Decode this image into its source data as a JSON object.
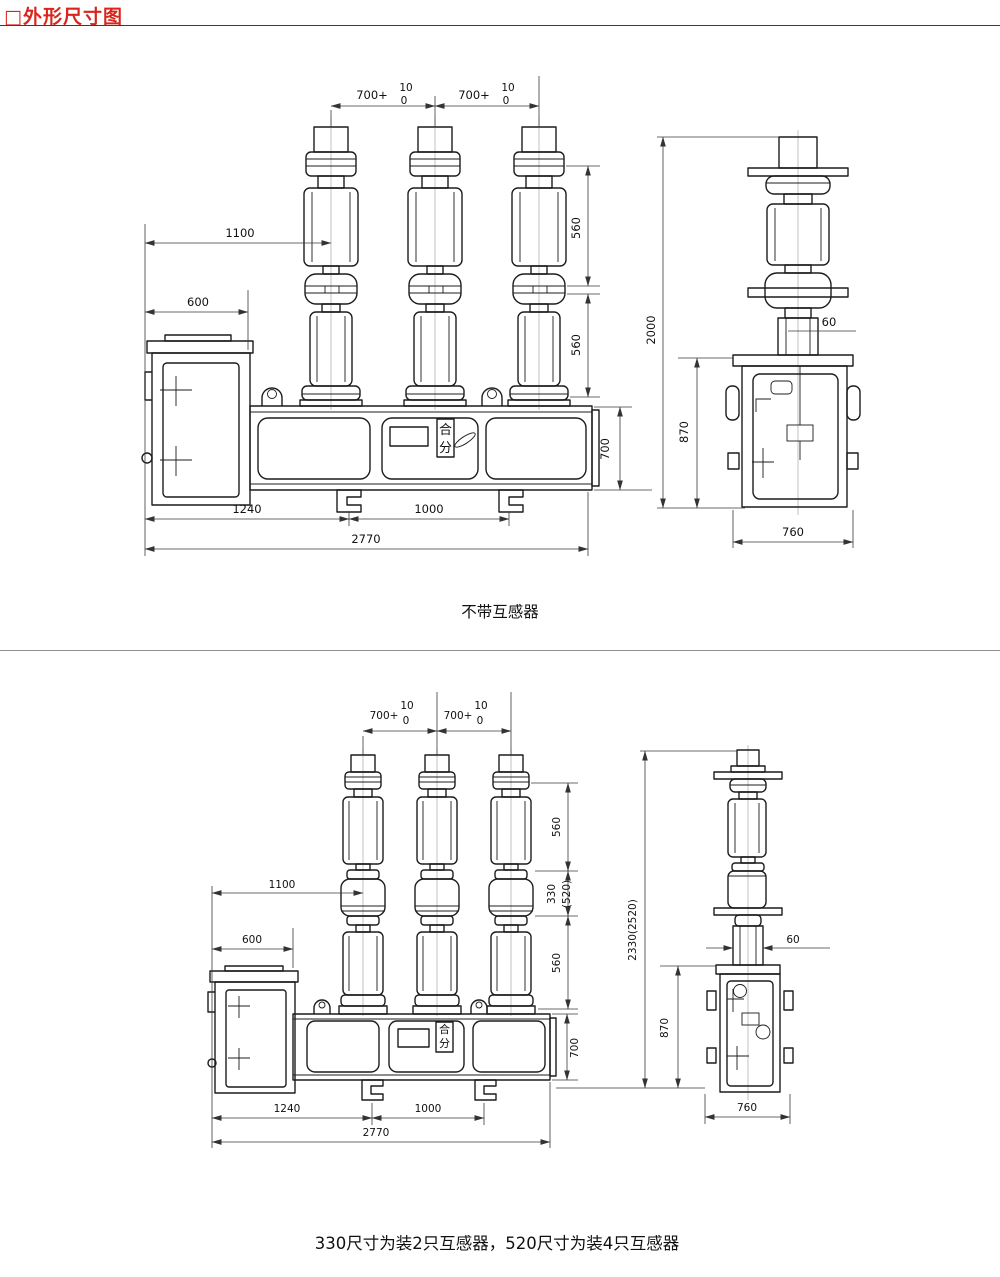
{
  "page": {
    "title": "□外形尺寸图",
    "accent_color": "#d9261c"
  },
  "figure1": {
    "caption": "不带互感器",
    "switch_label": {
      "close": "合",
      "open": "分"
    },
    "dims": {
      "pole_pitch": "700+",
      "pitch_tol_upper": "10",
      "pitch_tol_lower": "0",
      "terminal_reach": "1100",
      "cabinet_width": "600",
      "upper_insulator": "560",
      "lower_insulator": "560",
      "overall_height": "2000",
      "frame_height": "700",
      "cabinet_height": "870",
      "pole_width": "60",
      "base_span_left": "1240",
      "base_span_right": "1000",
      "overall_width": "2770",
      "cabinet_depth": "760"
    }
  },
  "figure2": {
    "caption": "330尺寸为装2只互感器，520尺寸为装4只互感器",
    "switch_label": {
      "close": "合",
      "open": "分"
    },
    "dims": {
      "pole_pitch": "700+",
      "pitch_tol_upper": "10",
      "pitch_tol_lower": "0",
      "terminal_reach": "1100",
      "cabinet_width": "600",
      "upper_insulator": "560",
      "ct_section": "330",
      "ct_section_alt": "(520)",
      "lower_insulator": "560",
      "overall_height": "2330(2520)",
      "frame_height": "700",
      "cabinet_height": "870",
      "pole_width": "60",
      "base_span_left": "1240",
      "base_span_right": "1000",
      "overall_width": "2770",
      "cabinet_depth": "760"
    }
  }
}
